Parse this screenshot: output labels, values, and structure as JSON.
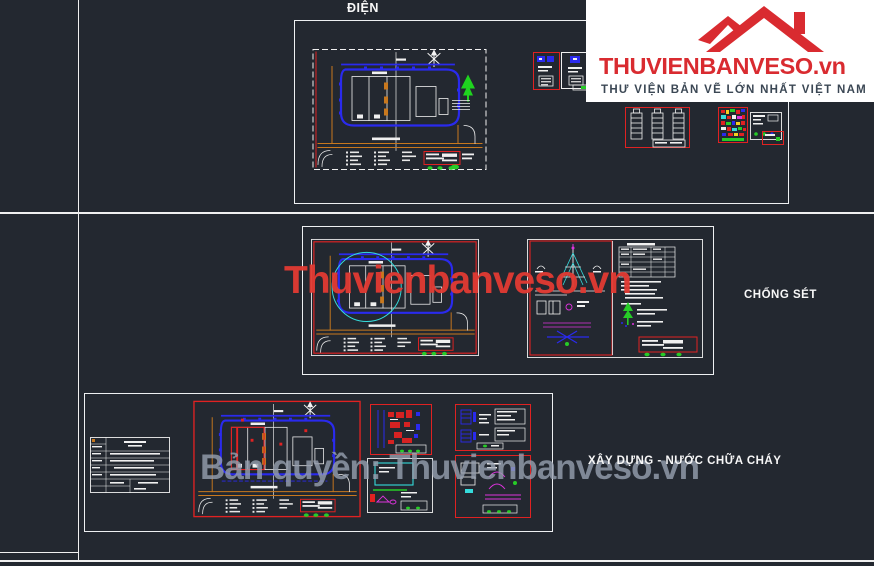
{
  "logo": {
    "brand": "THUVIENBANVESO",
    "domain": ".vn",
    "tagline": "THƯ VIỆN BẢN VẼ LỚN NHẤT VIỆT NAM",
    "brand_color": "#d92b30",
    "tagline_color": "#3b4754"
  },
  "sections": {
    "electrical": {
      "label": "ĐIỆN"
    },
    "lightning": {
      "label": "CHỐNG SÉT"
    },
    "water": {
      "label": "XÂY DỰNG - NƯỚC CHỮA CHÁY"
    }
  },
  "watermarks": {
    "center": "Thuvienbanveso.vn",
    "bottom": "Bản quyền: Thuvienbanveso.vn",
    "center_color": "#e23a33",
    "bottom_color": "#97a0b0"
  },
  "canvas_colors": {
    "background": "#232830",
    "cad_white": "#f0f0f0",
    "cad_blue": "#2a2aee",
    "cad_orange": "#c8781e",
    "cad_red": "#e02222",
    "cad_cyan": "#35dcdc",
    "cad_green": "#27cc27",
    "cad_magenta": "#dd33dd"
  }
}
